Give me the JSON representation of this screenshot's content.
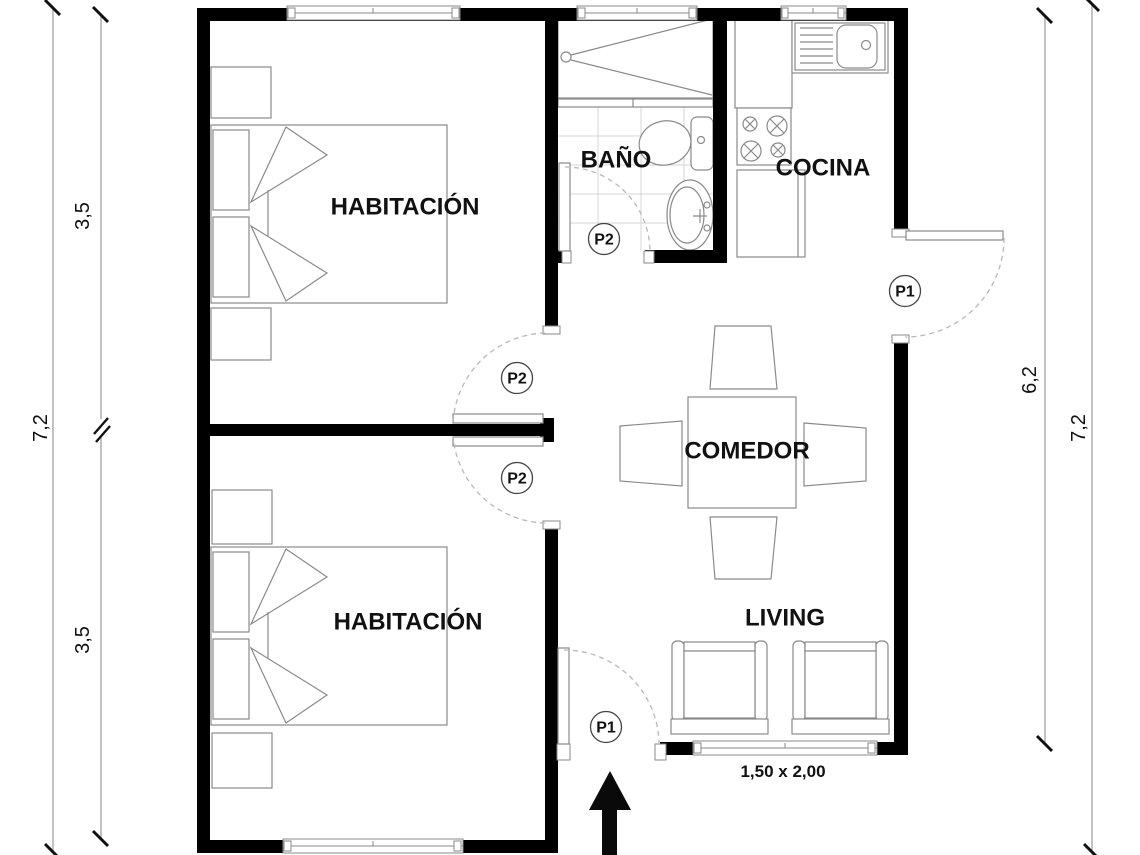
{
  "rooms": {
    "bedroom_top": "HABITACIÓN",
    "bedroom_bottom": "HABITACIÓN",
    "bathroom": "BAÑO",
    "kitchen": "COCINA",
    "dining": "COMEDOR",
    "living": "LIVING"
  },
  "doors": {
    "p1_entry": {
      "tag": "P1"
    },
    "p1_side": {
      "tag": "P1"
    },
    "p2_bathroom": {
      "tag": "P2"
    },
    "p2_bedroom_top": {
      "tag": "P2"
    },
    "p2_bedroom_bottom": {
      "tag": "P2"
    }
  },
  "dimensions": {
    "left_overall": "7,2",
    "left_bedroom_top": "3,5",
    "left_bedroom_bottom": "3,5",
    "right_living_depth": "6,2",
    "right_overall": "7,2",
    "living_window": "1,50 x 2,00"
  },
  "colors": {
    "wall": "#000000",
    "line": "#8a8a8a",
    "tile": "#d4d4d4",
    "dim": "#a8a8a8",
    "arc": "#b8b8b8",
    "ink": "#111111"
  }
}
